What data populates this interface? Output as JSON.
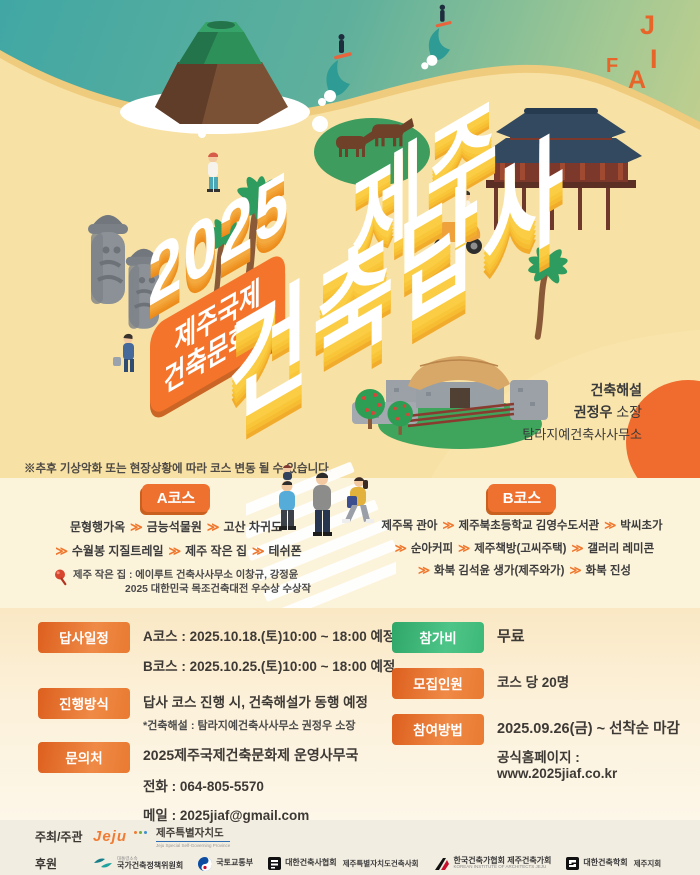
{
  "colors": {
    "accent_orange": "#EE7130",
    "badge_green": "#3FBC7C",
    "ocean_teal": "#3EA6A3",
    "sand": "#F8E1A4",
    "title_extrude_yellow": "#FACD44",
    "sun_orange": "#EF6B2E"
  },
  "icons": {
    "chevron": "≫"
  },
  "hero": {
    "logo_letters": [
      "J",
      "I",
      "F",
      "A"
    ],
    "year": "2025",
    "festival_line1": "제주국제",
    "festival_line2": "건축문화제",
    "title_jeju": "제주",
    "title_main": "건축답사",
    "guide": {
      "role": "건축해설",
      "name": "권정우",
      "title": "소장",
      "office": "탐라지예건축사사무소"
    }
  },
  "notice": "※추후 기상악화 또는 현장상황에 따라 코스 변동 될 수 있습니다.",
  "course_a": {
    "label": "A코스",
    "row1": [
      "문형행가옥",
      "금능석물원",
      "고산 차귀도"
    ],
    "row2": [
      "수월봉 지질트레일",
      "제주 작은 집",
      "테쉬폰"
    ],
    "note_line1": "제주 작은 집 : 에이루트 건축사사무소 이창규, 강정윤",
    "note_line2": "2025 대한민국 목조건축대전 우수상 수상작"
  },
  "course_b": {
    "label": "B코스",
    "row1": [
      "제주목 관아",
      "제주북초등학교 김영수도서관",
      "박씨초가"
    ],
    "row2": [
      "순아커피",
      "제주책방(고씨주택)",
      "갤러리 레미콘"
    ],
    "row3": [
      "화북 김석윤 생가(제주와가)",
      "화북 진성"
    ]
  },
  "info": {
    "schedule": {
      "label": "답사일정",
      "line1": "A코스 : 2025.10.18.(토)10:00 ~ 18:00 예정",
      "line2": "B코스 : 2025.10.25.(토)10:00 ~ 18:00 예정"
    },
    "method": {
      "label": "진행방식",
      "line1": "답사 코스 진행 시, 건축해설가 동행 예정",
      "line2": "*건축해설 : 탐라지예건축사사무소 권정우 소장"
    },
    "contact": {
      "label": "문의처",
      "line1": "2025제주국제건축문화제 운영사무국",
      "line2": "전화 : 064-805-5570",
      "line3": "메일 : 2025jiaf@gmail.com"
    },
    "fee": {
      "label": "참가비",
      "value": "무료"
    },
    "capacity": {
      "label": "모집인원",
      "value": "코스 당 20명"
    },
    "apply": {
      "label": "참여방법",
      "line1": "2025.09.26(금) ~ 선착순 마감",
      "line2": "공식홈페이지 : www.2025jiaf.co.kr"
    }
  },
  "footer": {
    "host_label": "주최/주관",
    "host": {
      "script": "Jeju",
      "name": "제주특별자치도",
      "eng": "Jeju Special Self-Governing Province"
    },
    "sponsor_label": "후원",
    "sponsors": [
      {
        "sub": "대통령소속",
        "name": "국가건축정책위원회"
      },
      {
        "name": "국토교통부"
      },
      {
        "name": "대한건축사협회",
        "side": "제주특별자치도건축사회"
      },
      {
        "name": "한국건축가협회 제주건축가회",
        "sub2": "KOREAN INSTITUTE OF ARCHITECTS JEJU"
      },
      {
        "name": "대한건축학회",
        "side": "제주지회"
      }
    ]
  }
}
